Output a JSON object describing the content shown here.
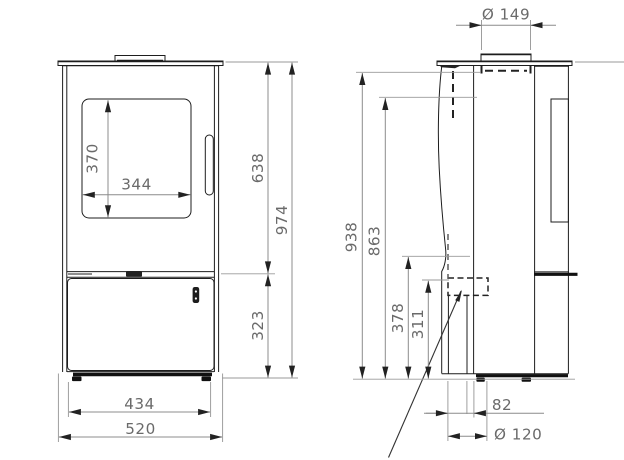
{
  "front_view": {
    "dimensions": {
      "glass_height": "370",
      "glass_width": "344",
      "top_to_base": "638",
      "overall_height": "974",
      "base_height": "323",
      "feet_width": "434",
      "overall_width": "520"
    }
  },
  "side_view": {
    "dimensions": {
      "flue_diameter": "Ø 149",
      "height_938": "938",
      "height_863": "863",
      "height_378": "378",
      "height_311": "311",
      "inlet_offset": "82",
      "inlet_diameter": "Ø 120"
    }
  },
  "colors": {
    "object_line": "#1d1d1d",
    "dimension_line": "#9a9a9a",
    "dimension_text": "#6a6a6a",
    "background": "#ffffff"
  }
}
